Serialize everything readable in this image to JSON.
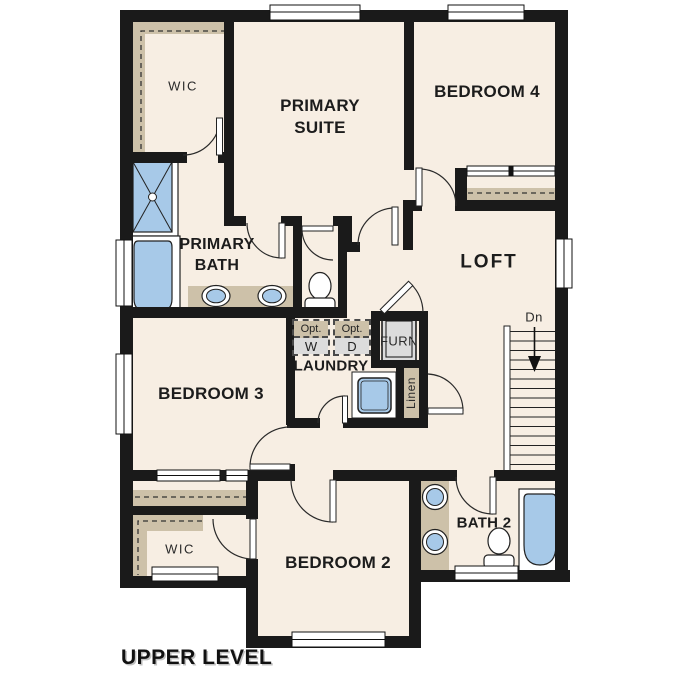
{
  "floor_title": "UPPER LEVEL",
  "colors": {
    "wall": "#1a1a1a",
    "cream": "#f7eee3",
    "tan": "#cdc1a9",
    "blue": "#a7c9e8",
    "gray": "#dcdcdc",
    "text": "#1c1c1c"
  },
  "rooms": {
    "wic_upper": "WIC",
    "primary_suite": "PRIMARY SUITE",
    "bedroom4": "BEDROOM 4",
    "primary_bath": "PRIMARY BATH",
    "loft": "LOFT",
    "laundry": "LAUNDRY",
    "furnace": "FURN",
    "linen": "Linen",
    "bedroom3": "BEDROOM 3",
    "bedroom2": "BEDROOM 2",
    "bath2": "BATH 2",
    "wic_lower": "WIC"
  },
  "stairs": {
    "direction_label": "Dn"
  },
  "laundry_options": {
    "washer": {
      "prefix": "Opt.",
      "letter": "W"
    },
    "dryer": {
      "prefix": "Opt.",
      "letter": "D"
    }
  }
}
